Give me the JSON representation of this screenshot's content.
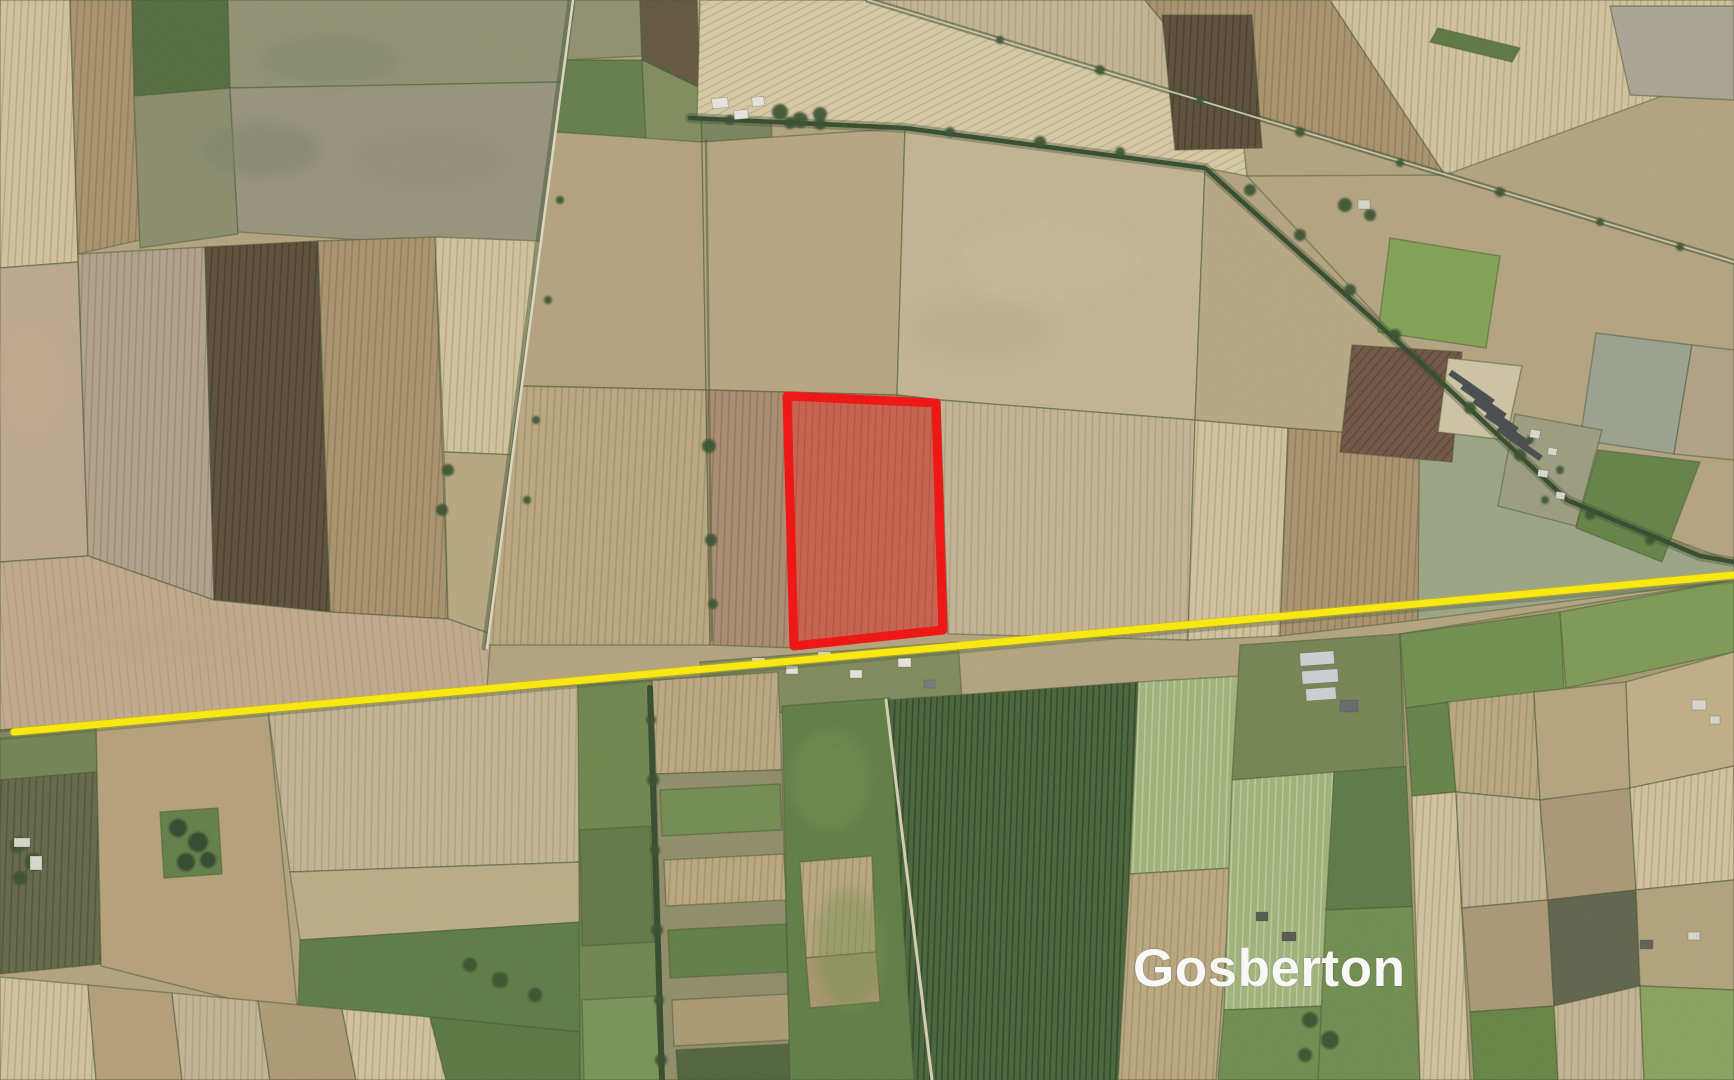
{
  "map": {
    "type": "satellite",
    "place_label": "Gosberton",
    "annotations": {
      "highlighted_parcel": {
        "shape": "quadrilateral",
        "outline_color": "#f40606",
        "fill": "rgba(252,12,6,0.36)",
        "points": "787,396 936,403 943,630 794,646"
      },
      "route_line": {
        "color": "#ffee00",
        "from": [
          14,
          732
        ],
        "to": [
          1734,
          575
        ]
      },
      "label_color": "#ffffff"
    }
  }
}
